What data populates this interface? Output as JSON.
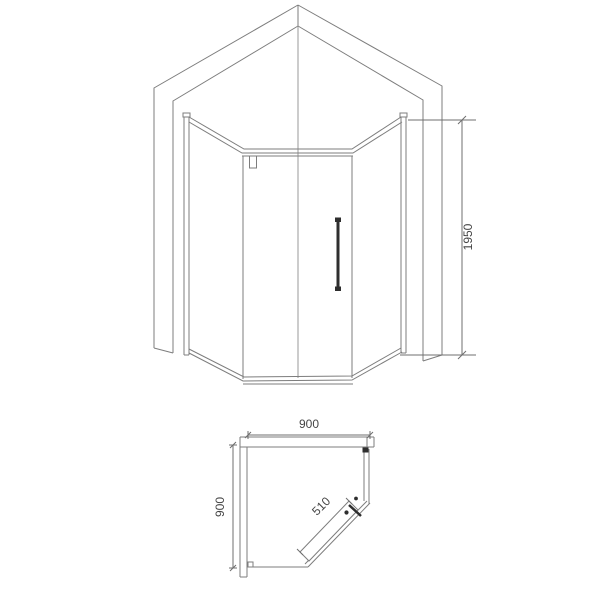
{
  "drawing": {
    "subject": "pentagon corner shower enclosure technical drawing",
    "line_color": "#7d7d7d",
    "dark_color": "#2e2e2e",
    "text_color": "#454545",
    "views": {
      "elevation": {
        "label": "front elevation",
        "height_dim": "1950"
      },
      "plan": {
        "label": "top plan view",
        "width_dim": "900",
        "depth_dim": "900",
        "door_dim": "510"
      }
    }
  }
}
